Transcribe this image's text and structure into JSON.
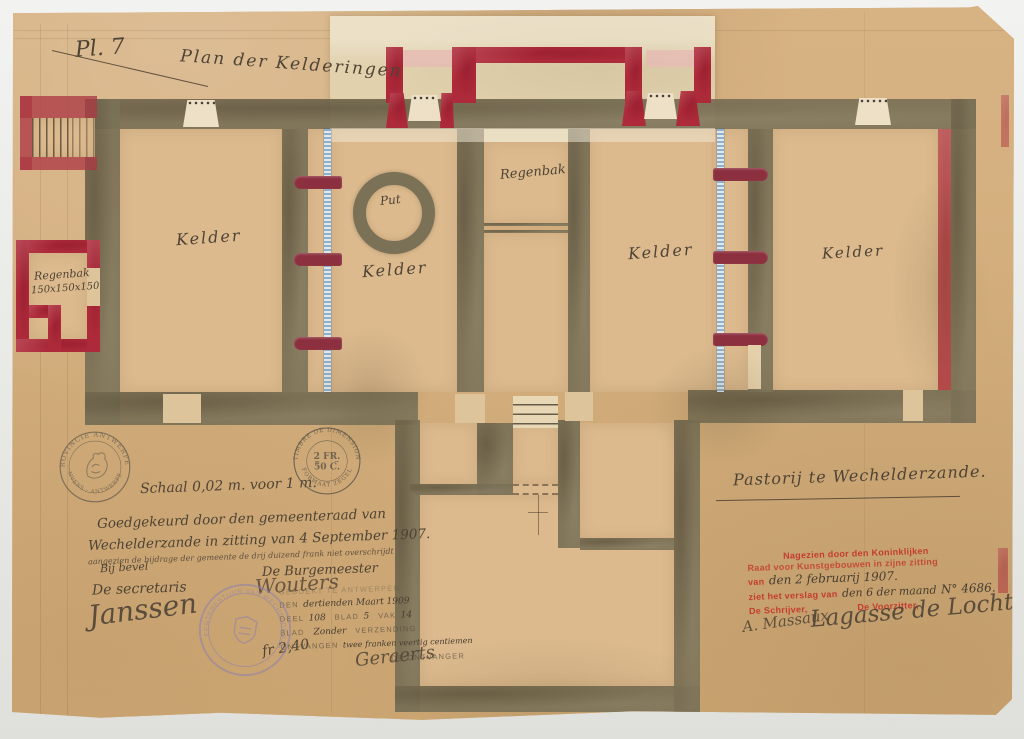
{
  "plate_label": "Pl. 7",
  "title": "Plan der Kelderingen",
  "plan_labels": {
    "kelder_1": "Kelder",
    "kelder_2": "Kelder",
    "kelder_3": "Kelder",
    "kelder_4": "Kelder",
    "put": "Put",
    "regenbak_center": "Regenbak",
    "regenbak_left_name": "Regenbak",
    "regenbak_left_size": "150x150x150"
  },
  "scale_note": "Schaal 0,02 m. voor 1 m.",
  "caption": "Pastorij te Wechelderzande.",
  "approval": {
    "line1": "Goedgekeurd door den gemeenteraad van",
    "line2": "Wechelderzande in zitting van 4 September 1907.",
    "line3": "aangezien de bijdrage der gemeente de drij duizend frank niet overschrijdt",
    "by_order": "Bij bevel",
    "secretary_title": "De secretaris",
    "mayor_title": "De Burgemeester",
    "secretary_signature": "Janssen",
    "mayor_signature": "Wouters"
  },
  "registration": {
    "line1": "GEBOEKT TE ANTWERPEN",
    "den_label": "DEN",
    "den_value": "dertienden Maart 1909",
    "deel_label": "DEEL",
    "deel_value": "108",
    "blad_label": "BLAD",
    "blad_value": "5",
    "vak_label": "VAK",
    "vak_value": "14",
    "blad2_label": "BLAD",
    "blad2_value": "Zonder",
    "verzending_label": "VERZENDING",
    "ontvangen_label": "ONTVANGEN",
    "ontvangen_value": "twee franken veertig centiemen",
    "receiver_title": "DE ONTVANGER",
    "fee": "fr 2,40",
    "receiver_signature": "Geraerts"
  },
  "royal_review": {
    "line1": "Nagezien door den Koninklijken",
    "line2": "Raad voor Kunstgebouwen in zijne zitting",
    "van_label": "van",
    "van_value": "den 2 februarij 1907.",
    "verslag_label": "ziet het verslag van",
    "verslag_value": "den 6 der maand",
    "number": "N° 4686.",
    "clerk_title": "De Schrijver,",
    "chair_title": "De Voorzitter,",
    "clerk_signature": "A. Massaux",
    "chair_signature": "Lagasse de Locht"
  },
  "seals": {
    "province": {
      "top": "PROVINCIE ANTWERPEN",
      "bottom": "ANVERS · ANTWERPEN"
    },
    "dimension": {
      "top": "TIMBRE DE DIMENSION",
      "value1": "2 FR.",
      "value2": "50 C.",
      "bottom": "FORMAAT ZEGEL"
    },
    "municipal": {
      "around": "GEMEENTEBESTUUR VAN WECHELDERZANDE"
    }
  },
  "colors": {
    "paper": "#d4ae7c",
    "wall_olive": "#7b7157",
    "wall_red": "#ad2a3a",
    "hatch_blue": "#8fb0cc",
    "stamp_purple": "#8d7fae",
    "stamp_red": "#c33c2f",
    "ink": "#4e4335"
  }
}
